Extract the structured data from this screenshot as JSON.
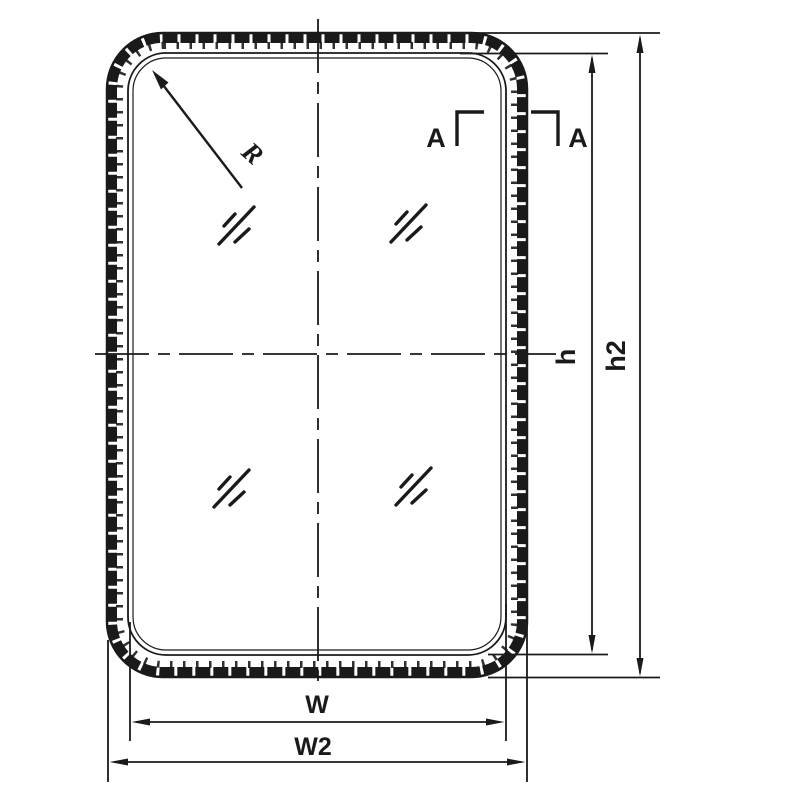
{
  "drawing": {
    "labels": {
      "radius": "R",
      "section_left": "A",
      "section_right": "A",
      "inner_height": "h",
      "outer_height": "h2",
      "inner_width": "W",
      "outer_width": "W2"
    },
    "colors": {
      "line": "#1a1a1a",
      "background": "#ffffff"
    }
  }
}
